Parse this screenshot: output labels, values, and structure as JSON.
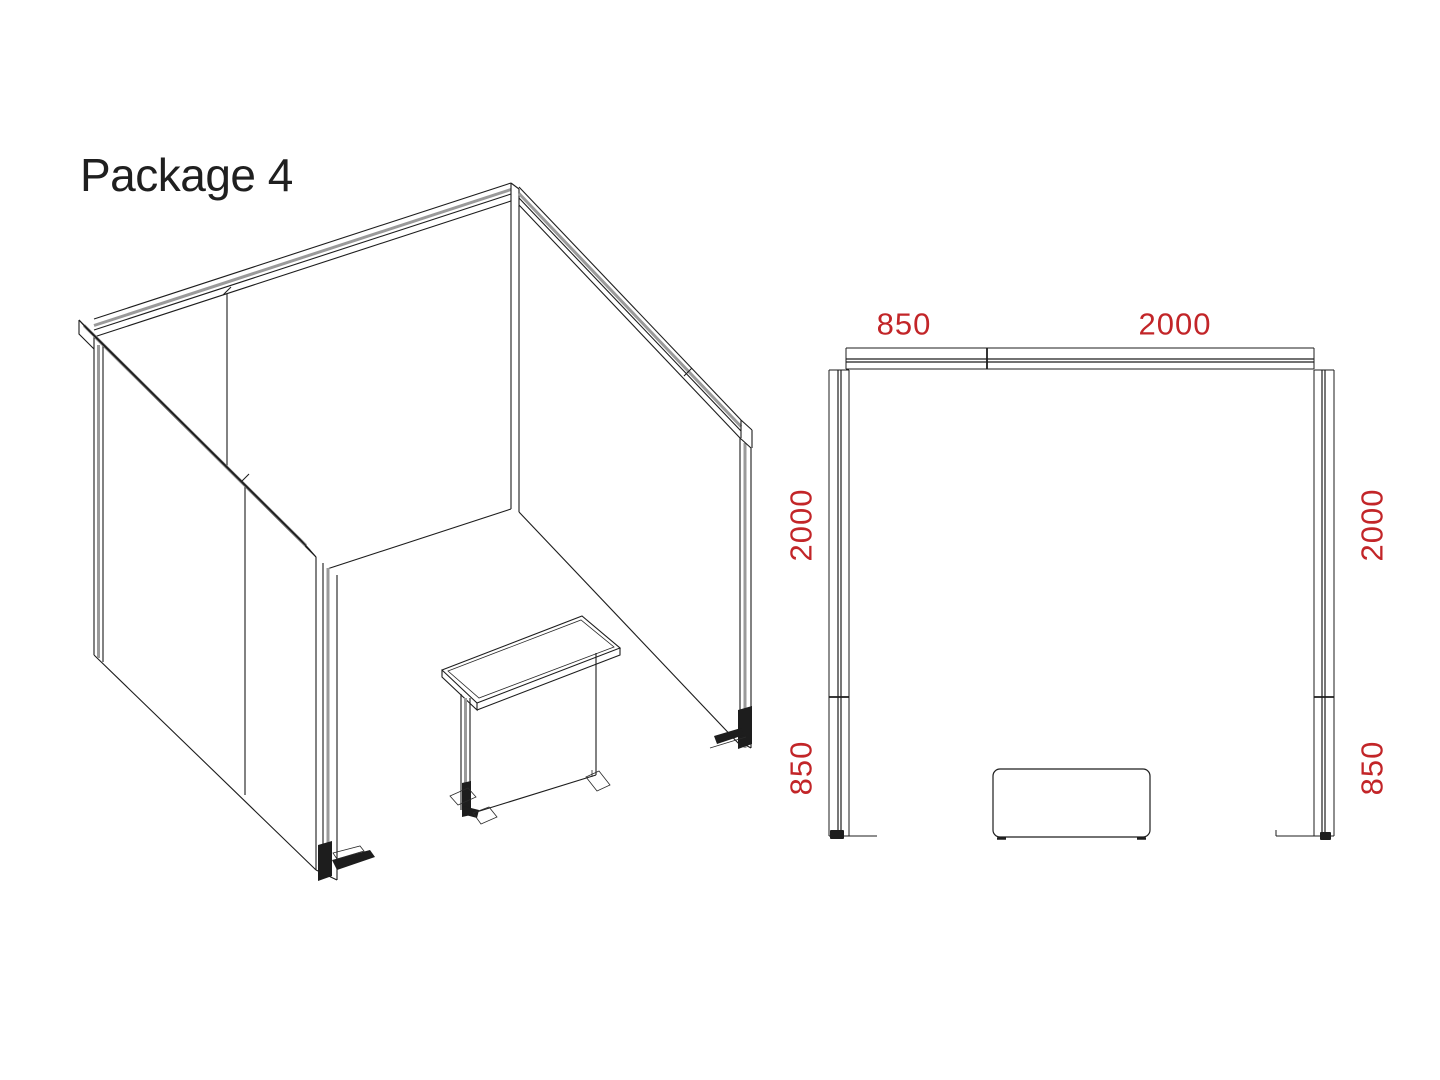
{
  "title": "Package 4",
  "plan": {
    "dim_top_left": "850",
    "dim_top_right": "2000",
    "dim_left_upper": "2000",
    "dim_left_lower": "850",
    "dim_right_upper": "2000",
    "dim_right_lower": "850"
  },
  "colors": {
    "line": "#1d1d1d",
    "rail_gray": "#9a9a9a",
    "dimension": "#c22528",
    "background": "#ffffff"
  }
}
